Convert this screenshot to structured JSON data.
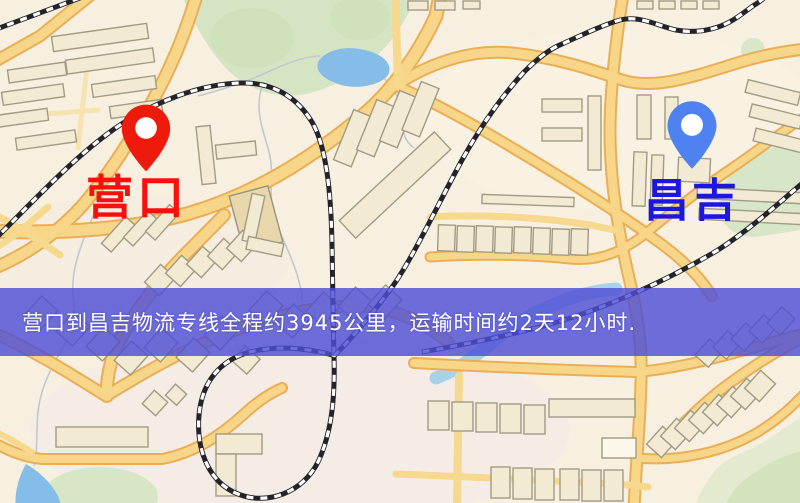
{
  "type": "logistics-route-map-screenshot",
  "banner": {
    "text": "营口到昌吉物流专线全程约3945公里，运输时间约2天12小时.",
    "distance_km": 3945,
    "duration_text": "2天12小时",
    "background_color": "#4e4ed5",
    "text_color": "#ffffff"
  },
  "markers": {
    "origin": {
      "label": "营口",
      "label_color": "#fb0e0e",
      "pin_color": "#ee1b0c",
      "pin_style": "map-pin"
    },
    "destination": {
      "label": "昌吉",
      "label_color": "#1c16e0",
      "pin_color": "#4f82f1",
      "pin_style": "map-pin"
    }
  },
  "map_palette": {
    "background": "#f7f0e0",
    "road_fill": "#f8d689",
    "road_casing": "#eaaf56",
    "building_fill": "#f2ead2",
    "building_stroke": "#a29b84",
    "park_green": "#d5e5c3",
    "water_blue": "#85bde8",
    "railway_black": "#23242b",
    "river_gray": "#c2c8cf"
  }
}
